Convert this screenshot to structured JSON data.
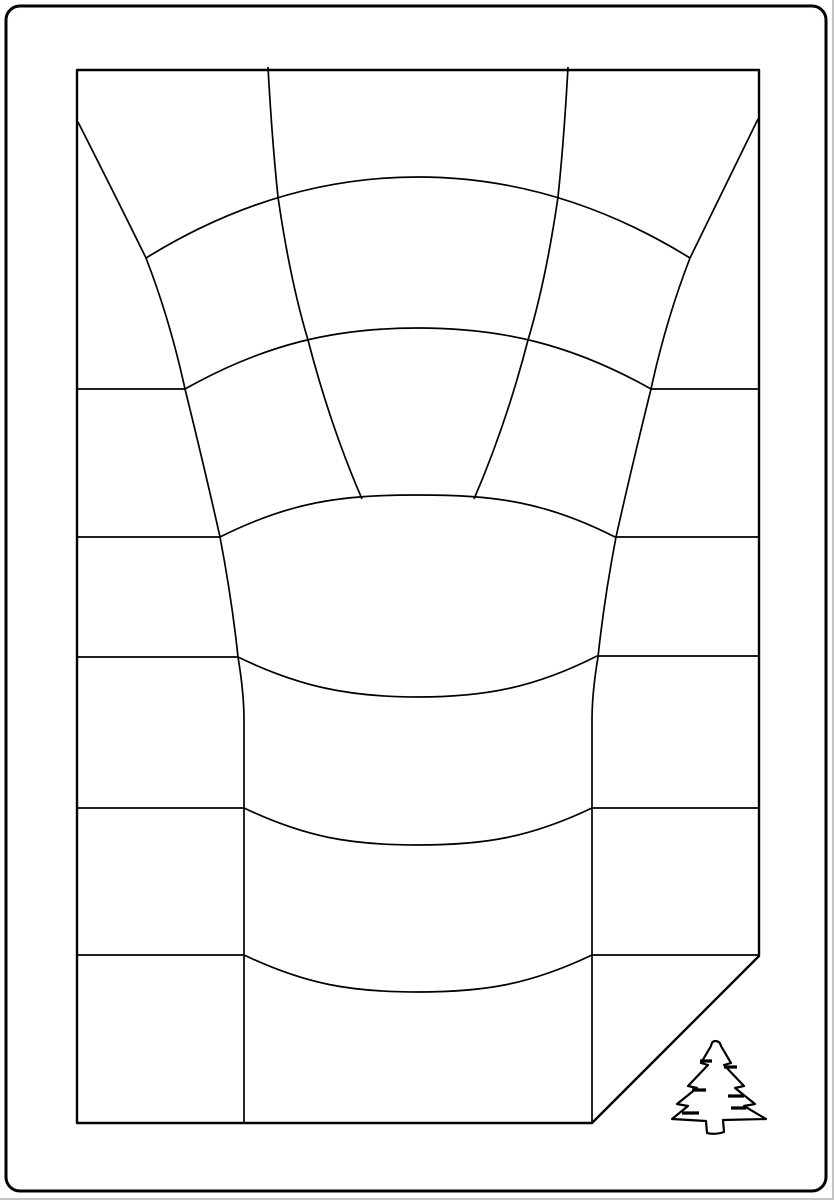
{
  "canvas": {
    "width": 834,
    "height": 1200,
    "background": "#ffffff",
    "ink": "#000000",
    "scan_artifact_color": "#c4c4c4"
  },
  "drawing": {
    "description": "line-art perspective well grid card with folded corner and pine tree",
    "paths": [
      {
        "name": "outer-border",
        "w": 3,
        "d": "M 20,6 H 812 A 14,14 0 0 1 826,20 V 1177 A 14,14 0 0 1 812,1191 H 20 A 14,14 0 0 1 6,1177 V 20 A 14,14 0 0 1 20,6 Z"
      },
      {
        "name": "sheet-outline-with-folded-corner",
        "w": 2.4,
        "d": "M 77,70 H 759 V 956 L 592,1123 H 77 Z"
      },
      {
        "name": "row-left-1",
        "w": 1.7,
        "d": "M 78,389 H 185"
      },
      {
        "name": "row-left-2",
        "w": 1.7,
        "d": "M 78,537 H 220"
      },
      {
        "name": "row-left-3",
        "w": 1.7,
        "d": "M 78,657 H 238"
      },
      {
        "name": "row-left-4",
        "w": 1.7,
        "d": "M 78,808 H 244"
      },
      {
        "name": "row-left-5",
        "w": 1.7,
        "d": "M 78,955 H 244"
      },
      {
        "name": "row-right-1",
        "w": 1.7,
        "d": "M 651,389 H 758"
      },
      {
        "name": "row-right-2",
        "w": 1.7,
        "d": "M 615,537 H 758"
      },
      {
        "name": "row-right-3",
        "w": 1.7,
        "d": "M 597,656 H 758"
      },
      {
        "name": "row-right-4",
        "w": 1.7,
        "d": "M 592,808 H 758"
      },
      {
        "name": "row-right-5",
        "w": 1.7,
        "d": "M 592,955 H 758"
      },
      {
        "name": "radial-left-outer",
        "w": 1.7,
        "d": "M 78,122 Q 120,205 146,258 Q 170,320 185,389 Q 205,470 220,537 Q 232,600 238,657 Q 244,693 244,720 L 244,1123"
      },
      {
        "name": "radial-right-outer",
        "w": 1.7,
        "d": "M 758,119 Q 716,205 690,258 Q 666,320 651,389 Q 631,470 616,537 Q 604,600 598,657 Q 592,693 592,720 L 592,1123"
      },
      {
        "name": "radial-left-inner",
        "w": 1.7,
        "d": "M 268,67 Q 272,140 278,197 Q 290,280 308,340 Q 330,425 362,499"
      },
      {
        "name": "radial-right-inner",
        "w": 1.7,
        "d": "M 568,67 Q 564,140 558,197 Q 546,280 528,340 Q 506,425 474,499"
      },
      {
        "name": "arc-top-dome",
        "w": 1.7,
        "d": "M 146,258 C 230,206 320,177 418,177 C 516,177 606,206 690,258"
      },
      {
        "name": "arc-row-1-dome",
        "w": 1.7,
        "d": "M 185,389 C 265,344 335,328 418,328 C 501,328 571,344 651,389"
      },
      {
        "name": "arc-row-2-dome",
        "w": 1.7,
        "d": "M 220,537 C 290,502 340,495 418,495 C 496,495 546,502 615,537"
      },
      {
        "name": "arc-row-3-sag",
        "w": 1.7,
        "d": "M 238,657 C 300,687 350,697 418,697 C 486,697 536,687 597,656"
      },
      {
        "name": "arc-row-4-sag",
        "w": 1.7,
        "d": "M 244,808 C 305,837 350,845 418,845 C 486,845 531,837 592,808"
      },
      {
        "name": "arc-row-5-sag",
        "w": 1.7,
        "d": "M 244,955 C 305,984 350,992 418,992 C 486,992 531,984 592,955"
      },
      {
        "name": "pine-tree-icon",
        "w": 2.2,
        "d": "M 715,1041 Q 720,1041 721,1046 L 731,1063 L 724,1065 L 744,1086 L 735,1088 L 755,1104 L 744,1106 L 766,1119 L 723,1120 L 724,1132 Q 715,1135 707,1133 L 706,1121 L 672,1119 L 688,1106 L 677,1104 L 697,1088 L 688,1086 L 708,1065 L 701,1063 L 711,1046 Q 712,1041 715,1041 Z"
      },
      {
        "name": "pine-tree-branch-marks",
        "w": 3.2,
        "d": "M 700,1061 H 712 M 724,1067 H 737 M 692,1090 H 706 M 728,1096 H 744 M 682,1113 H 699 M 731,1108 H 746"
      },
      {
        "name": "scan-edge-artifact-right",
        "w": 2,
        "color": "#c4c4c4",
        "d": "M 833,0 V 1200"
      },
      {
        "name": "scan-edge-artifact-bottom",
        "w": 2,
        "color": "#c4c4c4",
        "d": "M 0,1199 H 834"
      }
    ]
  }
}
